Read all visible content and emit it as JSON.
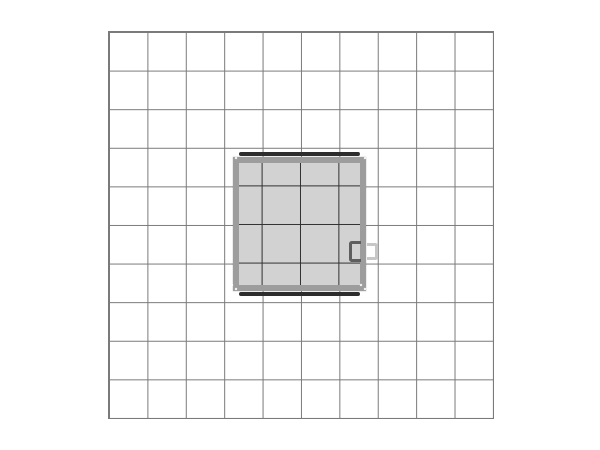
{
  "scene": {
    "grid": {
      "columns": 10,
      "rows": 10
    },
    "booth_interior_grid": {
      "visible_vertical_lines": 3,
      "visible_horizontal_lines": 3
    }
  },
  "colors": {
    "background": "#ffffff",
    "grid-line": "#7a7a7a",
    "grid-line-inner": "#303030",
    "frame": "#9d9d9d",
    "fill": "#d2d2d2",
    "bar": "#2d2d2d",
    "dot": "#ffffff",
    "handle-dark": "#5e5e5e",
    "handle-light": "#c7c7c7"
  }
}
